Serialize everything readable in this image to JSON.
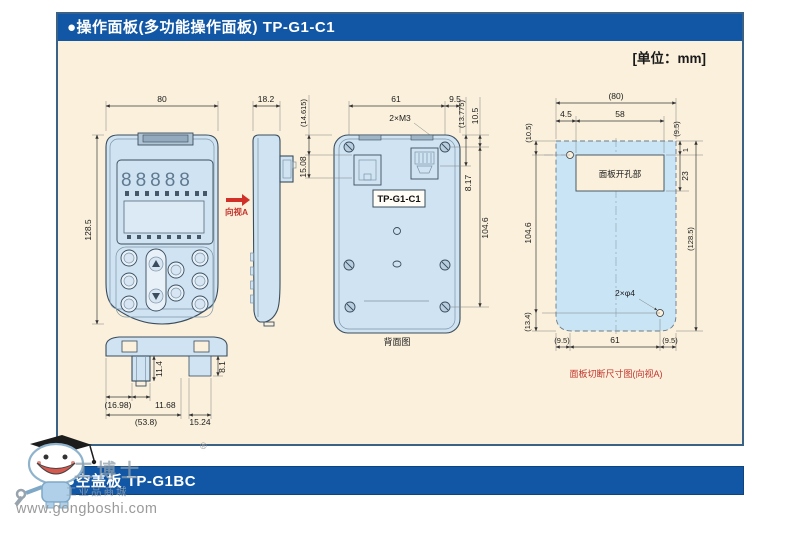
{
  "header": {
    "title": "●操作面板(多功能操作面板) TP-G1-C1",
    "unit_label": "[单位：mm]"
  },
  "footer": {
    "title": "●空盖板 TP-G1BC"
  },
  "watermark": {
    "site": "www.gongboshi.com",
    "registered": "®",
    "brand": "工博士",
    "brand_sub": "工业品商城"
  },
  "front_view": {
    "dim_width": "80",
    "dim_height": "128.5",
    "view_arrow": "向视A",
    "display_digits": "88888"
  },
  "side_view": {
    "dim_depth": "18.2"
  },
  "rear_view": {
    "caption": "背面图",
    "model": "TP-G1-C1",
    "screw_note": "2×M3",
    "dim_top_width": "61",
    "dim_top_right": "9.5",
    "dim_left_upper": "(14.615)",
    "dim_left_lower": "15.08",
    "dim_right_1": "(13.775)",
    "dim_right_2": "10.5",
    "dim_right_3": "8.17",
    "dim_right_height": "104.6"
  },
  "bottom_view": {
    "dim_conn_height": "11.4",
    "dim_right_height": "8.1",
    "dim_left": "(16.98)",
    "dim_conn_width": "11.68",
    "dim_total": "(53.8)",
    "dim_right": "15.24"
  },
  "cutout_view": {
    "caption": "面板切断尺寸图(向视A)",
    "opening_label": "面板开孔部",
    "holes_note": "2×φ4",
    "dim_total_width": "(80)",
    "dim_hole_offset": "4.5",
    "dim_opening_width": "58",
    "dim_left_top": "(10.5)",
    "dim_left_height": "104.6",
    "dim_left_bottom": "(13.4)",
    "dim_right_top": "(9.5)",
    "dim_edge": "1",
    "dim_opening_height": "23",
    "dim_right_height": "(128.5)",
    "dim_bottom_left": "(9.5)",
    "dim_bottom_center": "61",
    "dim_bottom_right": "(9.5)"
  }
}
